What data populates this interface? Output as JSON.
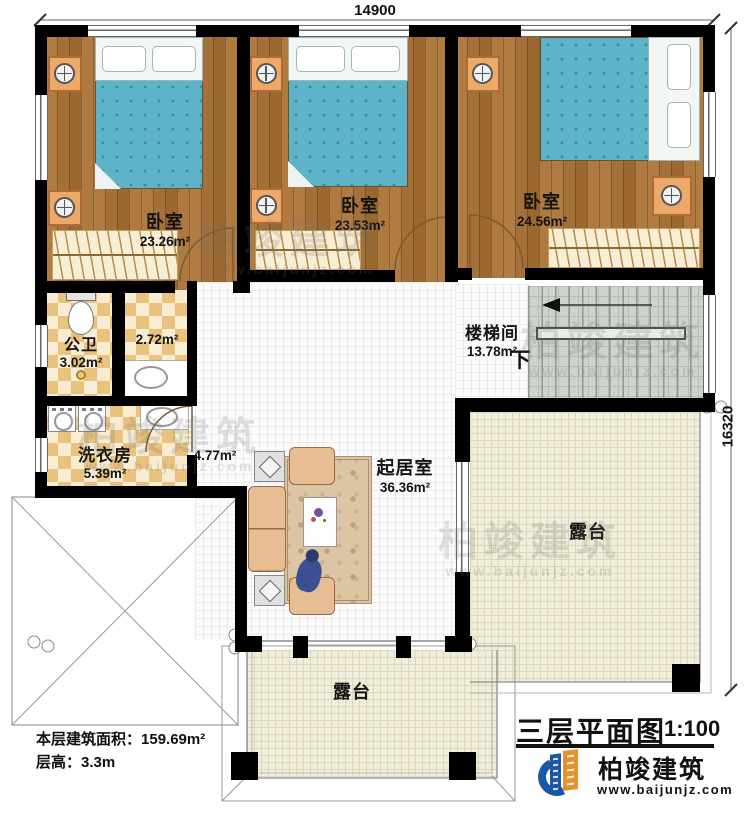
{
  "dimensions": {
    "top": "14900",
    "right": "16320"
  },
  "rooms": {
    "bedroom1": {
      "name": "卧室",
      "area": "23.26m²"
    },
    "bedroom2": {
      "name": "卧室",
      "area": "23.53m²"
    },
    "bedroom3": {
      "name": "卧室",
      "area": "24.56m²"
    },
    "bathroom": {
      "name": "公卫",
      "area": "3.02m²"
    },
    "washroom": {
      "area": "2.72m²"
    },
    "laundry": {
      "name": "洗衣房",
      "area": "5.39m²"
    },
    "hallway": {
      "area": "4.77m²"
    },
    "stairwell": {
      "name": "楼梯间",
      "area": "13.78m²",
      "direction_label": "下"
    },
    "living_room": {
      "name": "起居室",
      "area": "36.36m²"
    },
    "terrace_right": {
      "name": "露台"
    },
    "terrace_bottom": {
      "name": "露台"
    }
  },
  "info": {
    "area_label": "本层建筑面积：",
    "area_value": "159.69m²",
    "height_label": "层高：",
    "height_value": "3.3m"
  },
  "title_block": {
    "title": "三层平面图",
    "scale": "1:100",
    "brand": "柏竣建筑",
    "website": "www.baijunjz.com"
  },
  "watermark": {
    "line1": "柏竣建筑",
    "line2": "www.baijunjz.com"
  },
  "colors": {
    "wall": "#000000",
    "wood_floor": "#a9743a",
    "tile_checker": "#e9c27e",
    "terrace_tile": "#f0edda",
    "stair_floor": "#cdd4cc",
    "bed_blanket": "#5fb3c8",
    "accent_orange": "#e8922d",
    "brand_blue": "#1b57a6"
  }
}
